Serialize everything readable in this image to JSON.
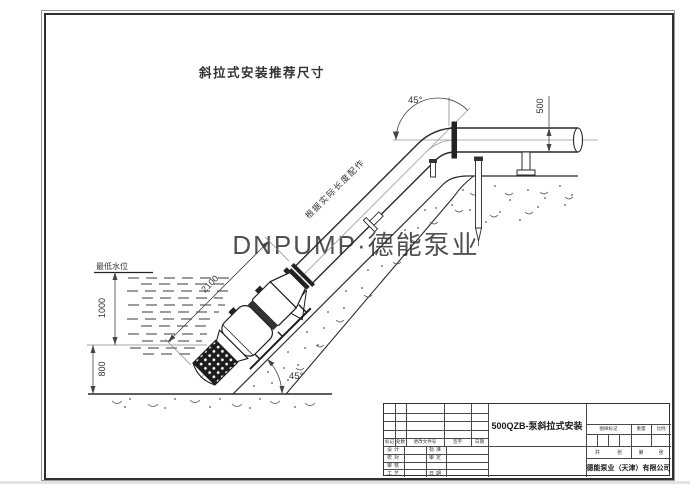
{
  "drawing_title": "斜拉式安装推荐尺寸",
  "watermark": "DNPUMP·德能泵业",
  "labels": {
    "water_level": "最低水位",
    "pipe_note": "根据实际长度配作"
  },
  "dimensions": {
    "vertical_upper": "1000",
    "vertical_lower": "800",
    "pump_length": "2100",
    "pipe_diameter": "500",
    "bend_angle": "45°",
    "slope_angle": "45°"
  },
  "title_block": {
    "product": "500QZB-泵斜拉式安装",
    "company": "德能泵业（天津）有限公司",
    "revision_columns": [
      "标记",
      "处数",
      "更改文件号",
      "签字",
      "日期"
    ],
    "sign_left": [
      "设计",
      "校对",
      "审核",
      "工艺"
    ],
    "sign_right": [
      "标准",
      "审定",
      "",
      "日期"
    ],
    "info_columns": [
      "图样标记",
      "重量",
      "比例"
    ],
    "sheet": {
      "total_label": "共",
      "total_unit": "张",
      "page_label": "第",
      "page_unit": "张"
    }
  },
  "colors": {
    "line": "#2a2a2a",
    "dim": "#444444",
    "watermark": "#c5c5c5"
  }
}
